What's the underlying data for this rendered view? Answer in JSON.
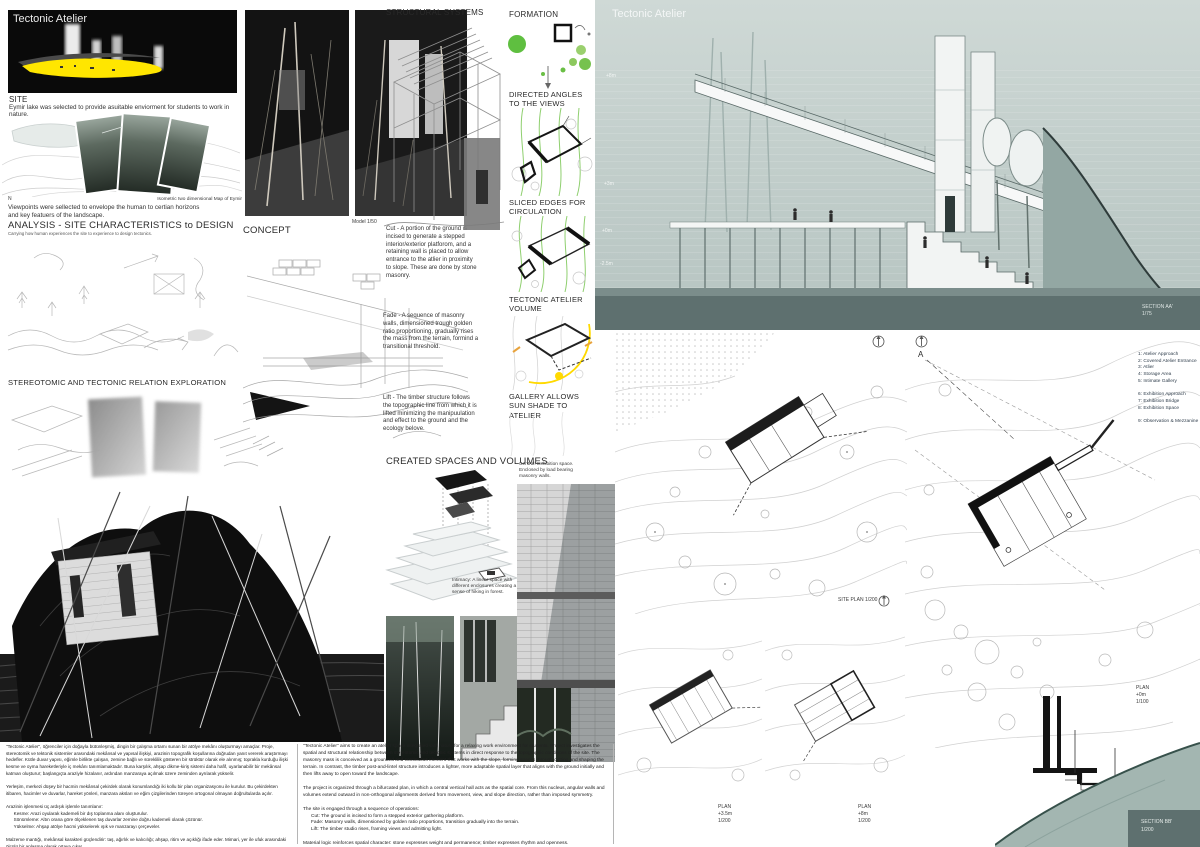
{
  "board": {
    "title": "Tectonic Atelier"
  },
  "hero": {
    "title": "Tectonic Atelier"
  },
  "site": {
    "heading": "SITE",
    "body": "Eymir lake was selected to provide asuitable enviorment for students to work in nature.",
    "north": "N",
    "map_caption": "Isometric two dimensional Map of Eymir",
    "viewpoints": "Viewpoints were sellected to envelope the human to certian horizons\nand key featuers of the landscape."
  },
  "analysis": {
    "heading": "ANALYSIS - SITE CHARACTERISTICS to DESIGN",
    "subheading": "Carrying how human experiences the site to experience to design tectonics."
  },
  "stereotomic": {
    "heading": "STEREOTOMIC AND TECTONIC RELATION EXPLORATION"
  },
  "concept": {
    "heading": "CONCEPT",
    "model_caption": "Model 1/50",
    "cut": "Cut - A portion of the ground is incised to generate a stepped interior/exterior platforom, and a retaining wall is placed to allow entrance to the atlier in proximity to slope. These are done by stone masonry.",
    "fade": "Fade - A sequence of masonry walls, dimensioned trough golden ratio proportioning, gradually rises the mass from the terrain, formind a transitional threshold.",
    "lift": "Lift - The timber structure follows the topographic line from which it is lifted minimizing the manipuulation and effect to the ground and the ecology belove."
  },
  "structural": {
    "heading": "STRUCTURAL SYSTEMS"
  },
  "formation": {
    "heading": "FORMATION",
    "step_views": "DIRECTED ANGLES TO THE VIEWS",
    "step_sliced": "SLICED EDGES FOR CIRCULATION",
    "step_volume": "TECTONIC ATELIER VOLUME",
    "step_gallery": "GALLERY ALLOWS SUN SHADE TO ATELIER"
  },
  "created": {
    "heading": "CREATED SPACES AND VOLUMES",
    "caption_central": "Central: Exhibition space.\nEnclosed by load bearing\nmasonry walls.",
    "caption_intimacy": "Intimacy: A linear space with\ndifferent enclosures creating a\nsense of hiking in forest.",
    "caption_staged": "Staged Studio:\nDiffrent spaces in\nproximity."
  },
  "section_aa": {
    "title": "Tectonic Atelier",
    "level_1": "+8m",
    "level_2": "+3m",
    "level_3": "+0m",
    "level_4": "-2.5m",
    "label": "SECTION AA'",
    "scale": "1/75"
  },
  "plans": {
    "site_plan_label": "SITE PLAN 1/200",
    "plan_35_label": "PLAN\n+3.5m\n1/200",
    "plan_8_label": "PLAN\n+8m\n1/200",
    "plan_0_label": "PLAN\n+0m\n1/100",
    "marker_a": "A",
    "legend": "1: Atelier Approach\n2: Covered Atelier Entrance\n3: Atlier\n4: Storage Area\n5: Intimate Gallery\n\n6: Exhibition Approach\n7: Exhibition Bridge\n8: Exhibition Space\n\n9: Observation & Mezzanine"
  },
  "section_bb": {
    "label": "SECTION BB'",
    "scale": "1/200"
  },
  "footer": {
    "turkish": "\"Tectonic Atelier\", öğrenciler için doğayla bütünleşmiş, dingin bir çalışma ortamı sunan bir atölye mekânı oluşturmayı amaçlar. Proje, stereotomik ve tektonik sistemler arasındaki mekânsal ve yapısal ilişkiyi, arazinin topografik koşullarına doğrudan yanıt vererek araştırmayı hedefler. Kütle duvar yapısı, eğimle birlikte çalışan, zemine bağlı ve süreklilik gösteren bir strüktür olarak ele alınmış; toprakla kurduğu ilişki kesme ve oyma hareketleriyle iç mekânı tanımlamaktadır. Buna karşılık, ahşap dikme-kiriş sistemi daha hafif, uyarlanabilir bir mekânsal katman oluşturur; başlangıçta araziyle hizalanır, ardından manzaraya açılmak üzere zeminden ayrılarak yükselir.\n\nYerleşim, merkezi düşey bir hacmin mekânsal çekirdek olarak konumlandığı iki kollu bir plan organizasyonu ile kurulur. Bu çekirdekten itibaren, hacimler ve duvarlar, hareket yönleri, manzara aksları ve eğim çizgilerinden türeyen ortogonal olmayan doğrultularda açılır.\n\nArazinin işlenmesi üç ardışık işlemle tanımlanır:\n      Kesme: Arazi oyularak kademeli bir dış toplanma alanı oluşturulur.\n      Sönümleme: Altın orana göre ölçeklenen taş duvarlar zemine doğru kademeli olarak çözünür.\n      Yükselme: Ahşap atölye hacmi yükselerek ışık ve manzarayı çerçeveler.\n\nMalzeme mantığı, mekânsal karakteri güçlendirir: taş, ağırlık ve kalıcılığı; ahşap, ritim ve açıklığı ifade eder. Mimari, yer ile ufuk arasındaki ölçülü bir anlaşma olarak ortaya çıkar.",
    "english": "\"Tectonic Atelier\" aims to create an atelier space integrated with nature for a relaxing work environment for students. Project investigates the spatial and structural relationship between stereotomic and tectonic systems in direct response to the topographic conditions of the site. The masonry mass is conceived as a grounded and continuous element that works with the slope, forming spaces through cutting and shaping the terrain. In contrast, the timber post-and-lintel structure introduces a lighter, more adaptable spatial layer that aligns with the ground initially and then lifts away to open toward the landscape.\n\nThe project is organized through a bifurcated plan, in which a central vertical hall acts as the spatial core. From this nucleus, angular walls and volumes extend outward in non-orthogonal alignments derived from movement, view, and slope direction, rather than imposed symmetry.\n\nThe site is engaged through a sequence of operations:\n      Cut: The ground is incised to form a stepped exterior gathering platform.\n      Fade: Masonry walls, dimensioned by golden ratio proportions, transition gradually into the terrain.\n      Lift: The timber studio rises, framing views and admitting light.\n\nMaterial logic reinforces spatial character: stone expresses weight and permanence; timber expresses rhythm and openness.\nThe architecture emerges as a constructed negotiation between earth and horizon."
  },
  "colors": {
    "accent_green": "#6abf45",
    "accent_yellow": "#ffdf00",
    "sage_panel": "#c2cfcc"
  }
}
